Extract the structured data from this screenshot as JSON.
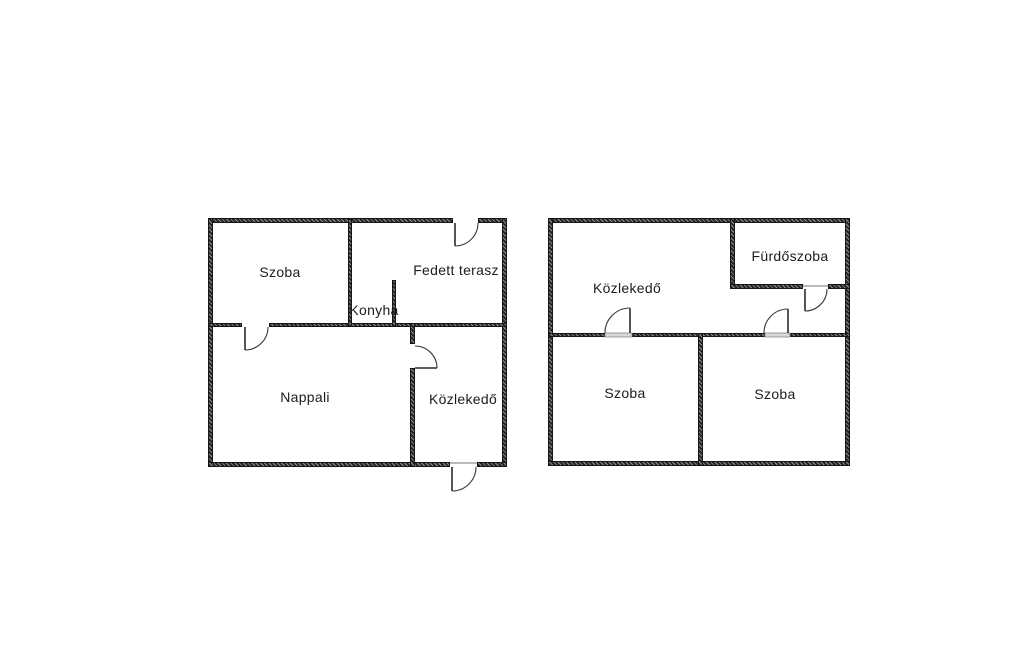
{
  "title": "Floor plans",
  "colors": {
    "background": "#ffffff",
    "wall": "#262626",
    "text": "#1c1c1c",
    "threshold": "#d8d8d8"
  },
  "plans": [
    {
      "name": "left-floor-plan",
      "rooms": [
        {
          "label": "Szoba"
        },
        {
          "label": "Fedett terasz"
        },
        {
          "label": "Konyha"
        },
        {
          "label": "Nappali"
        },
        {
          "label": "Közlekedő"
        }
      ]
    },
    {
      "name": "right-floor-plan",
      "rooms": [
        {
          "label": "Közlekedő"
        },
        {
          "label": "Fürdőszoba"
        },
        {
          "label": "Szoba"
        },
        {
          "label": "Szoba"
        }
      ]
    }
  ]
}
